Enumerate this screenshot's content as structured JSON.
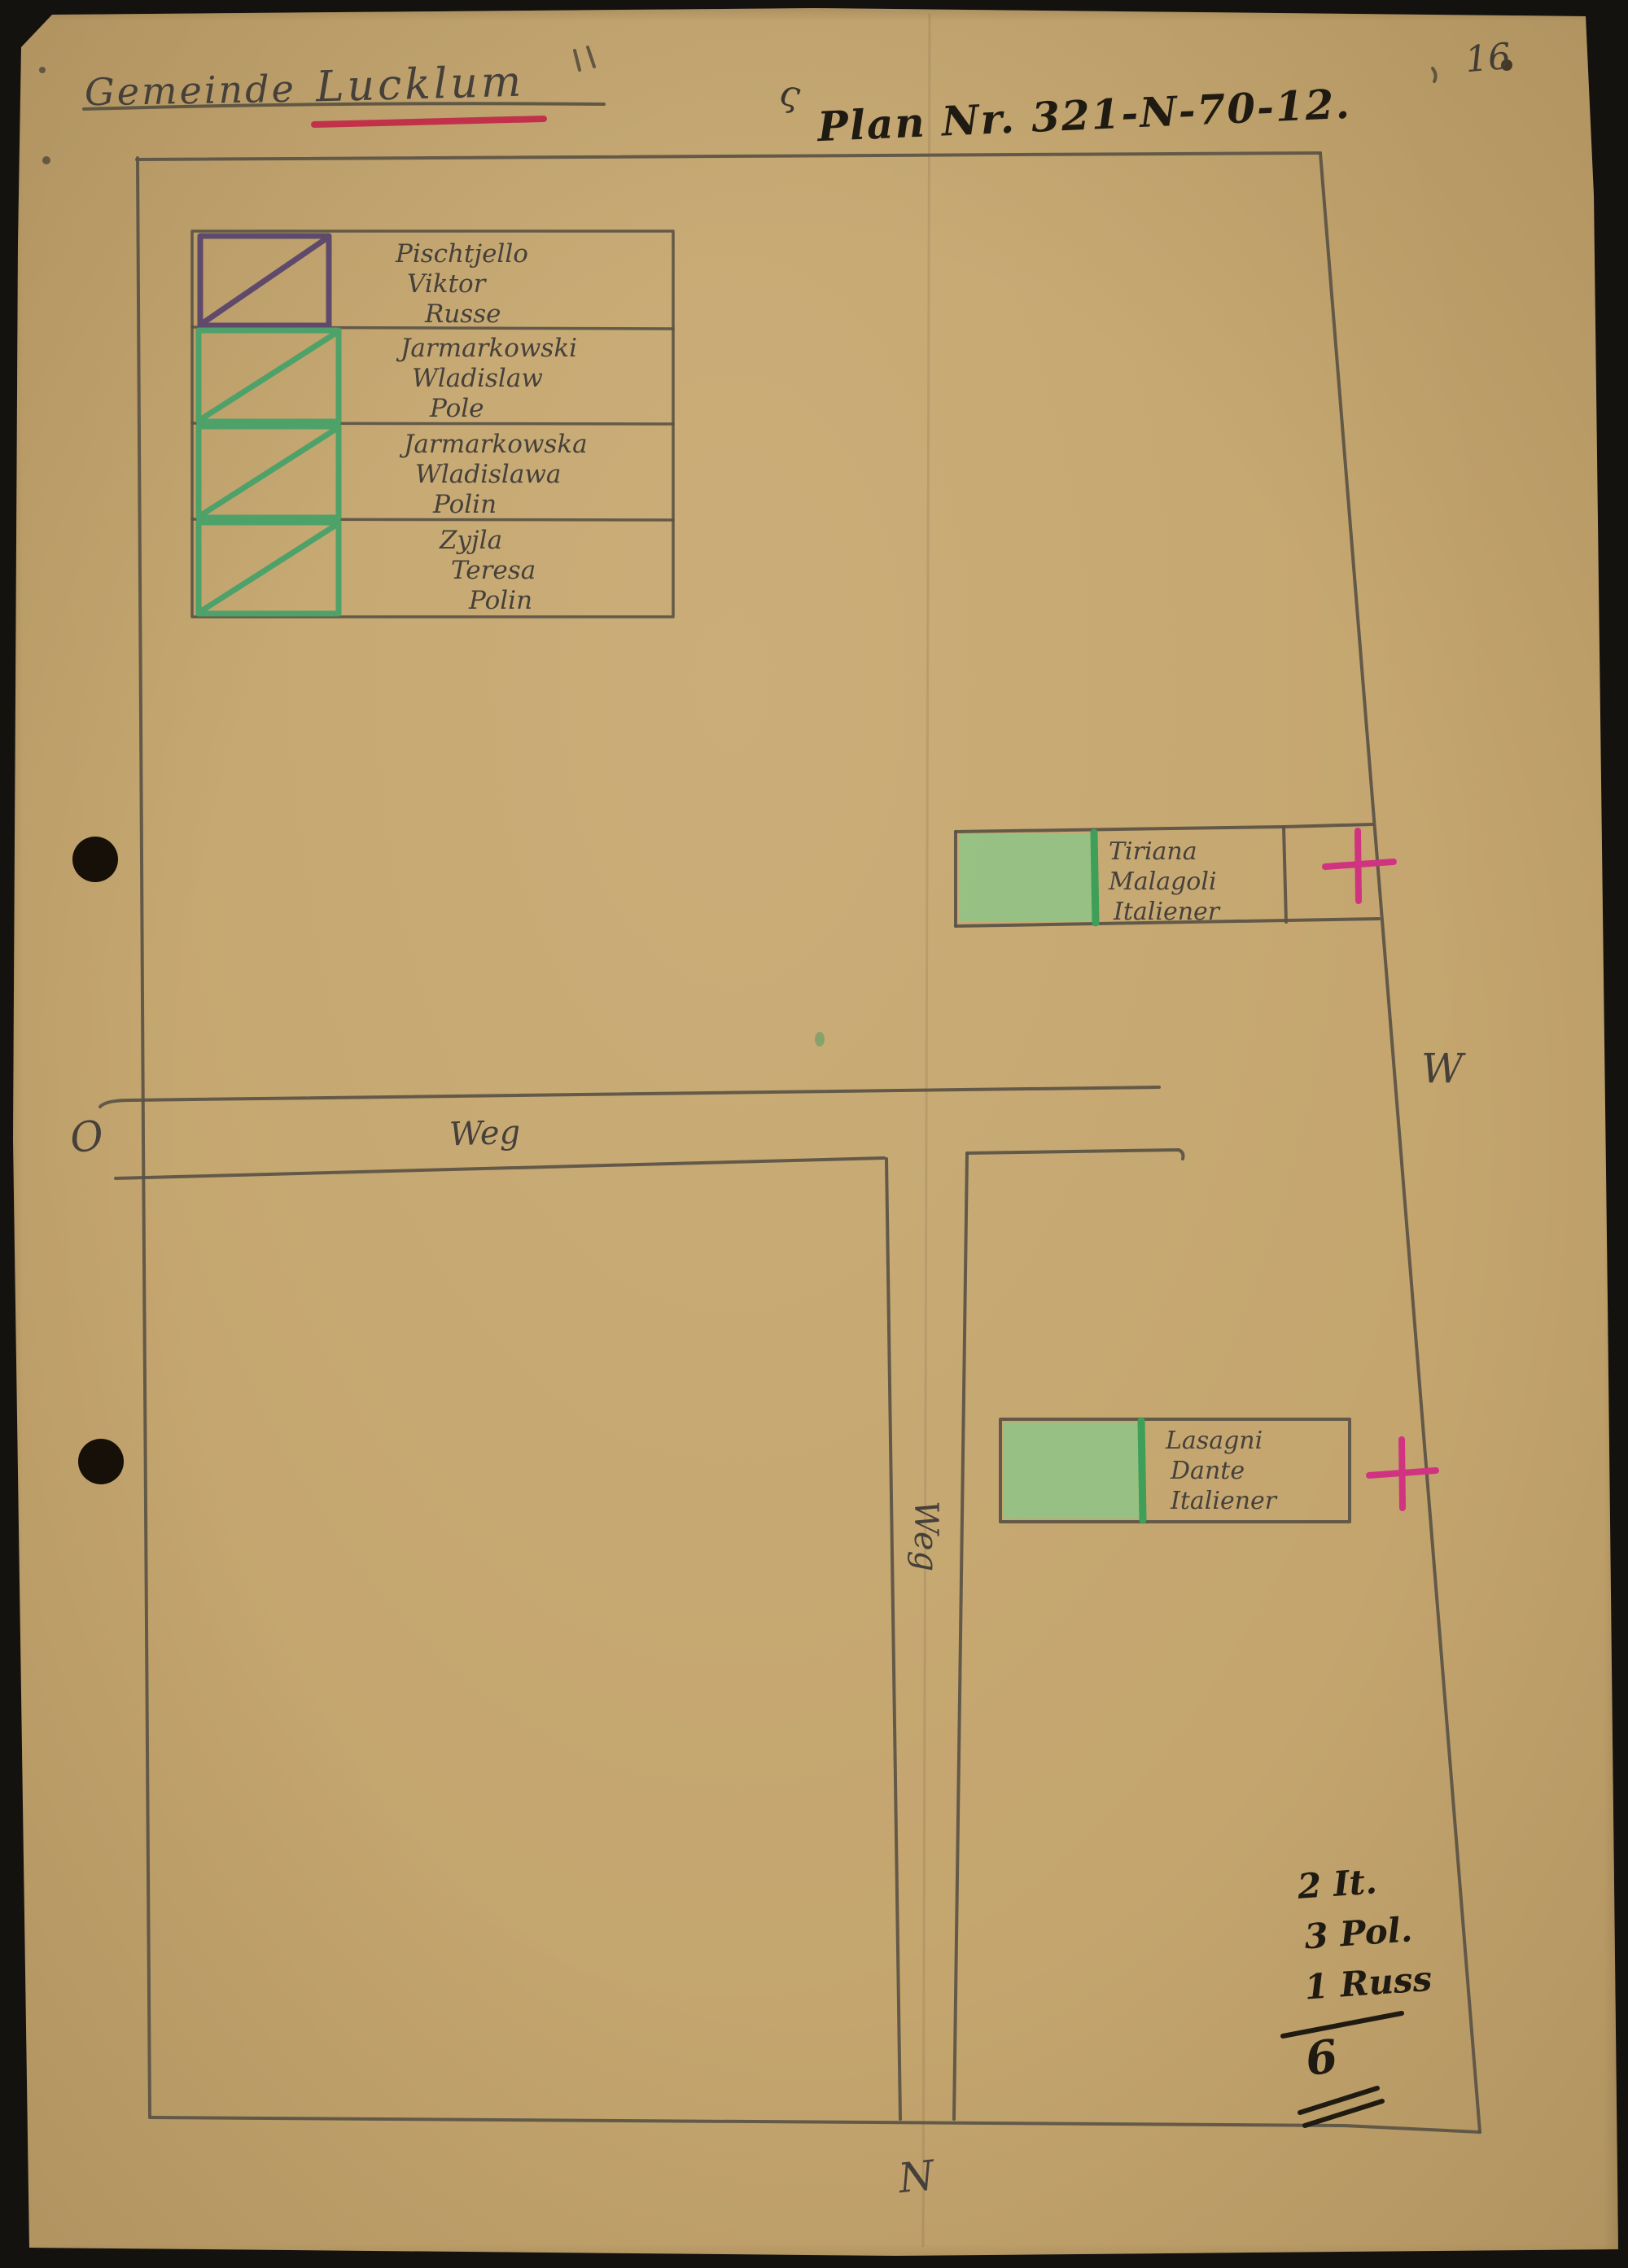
{
  "page": {
    "number": "16",
    "corner_squiggle": "ς"
  },
  "header": {
    "label": "Gemeinde",
    "place": "Lucklum"
  },
  "plan": {
    "title": "Plan Nr. 321-N-70-12."
  },
  "legend": {
    "entries": [
      {
        "line1": "Pischtjello",
        "line2": "Viktor",
        "line3": "Russe",
        "marker": "purple-square-diagonal",
        "marker_color": "#5f4a6b"
      },
      {
        "line1": "Jarmarkowski",
        "line2": "Wladislaw",
        "line3": "Pole",
        "marker": "green-square-diagonal",
        "marker_color": "#4ea269"
      },
      {
        "line1": "Jarmarkowska",
        "line2": "Wladislawa",
        "line3": "Polin",
        "marker": "green-square-diagonal",
        "marker_color": "#4ea269"
      },
      {
        "line1": "Zyjla",
        "line2": "Teresa",
        "line3": "Polin",
        "marker": "green-square-diagonal",
        "marker_color": "#4ea269"
      }
    ]
  },
  "plots": {
    "tiriana": {
      "line1": "Tiriana",
      "line2": "Malagoli",
      "line3": "Italiener",
      "fill_color": "#8ec587",
      "cross_color": "#d03380"
    },
    "lasagni": {
      "line1": "Lasagni",
      "line2": "Dante",
      "line3": "Italiener",
      "fill_color": "#8ec587",
      "cross_color": "#d03380"
    }
  },
  "roads": {
    "horizontal_label": "Weg",
    "vertical_label": "Weg"
  },
  "compass": {
    "east": "O",
    "west": "W",
    "north": "N"
  },
  "tally": {
    "row1": "2 It.",
    "row2": "3 Pol.",
    "row3": "1 Russ",
    "total": "6"
  },
  "colors": {
    "paper": "#c4a56e",
    "background": "#14120f",
    "pencil": "#5a5244",
    "ink": "#201b12",
    "red_underline": "#c22748",
    "pink_cross": "#d03380",
    "green_fill": "#8ec587",
    "green_marker": "#4ea269",
    "purple_marker": "#5f4a6b"
  }
}
